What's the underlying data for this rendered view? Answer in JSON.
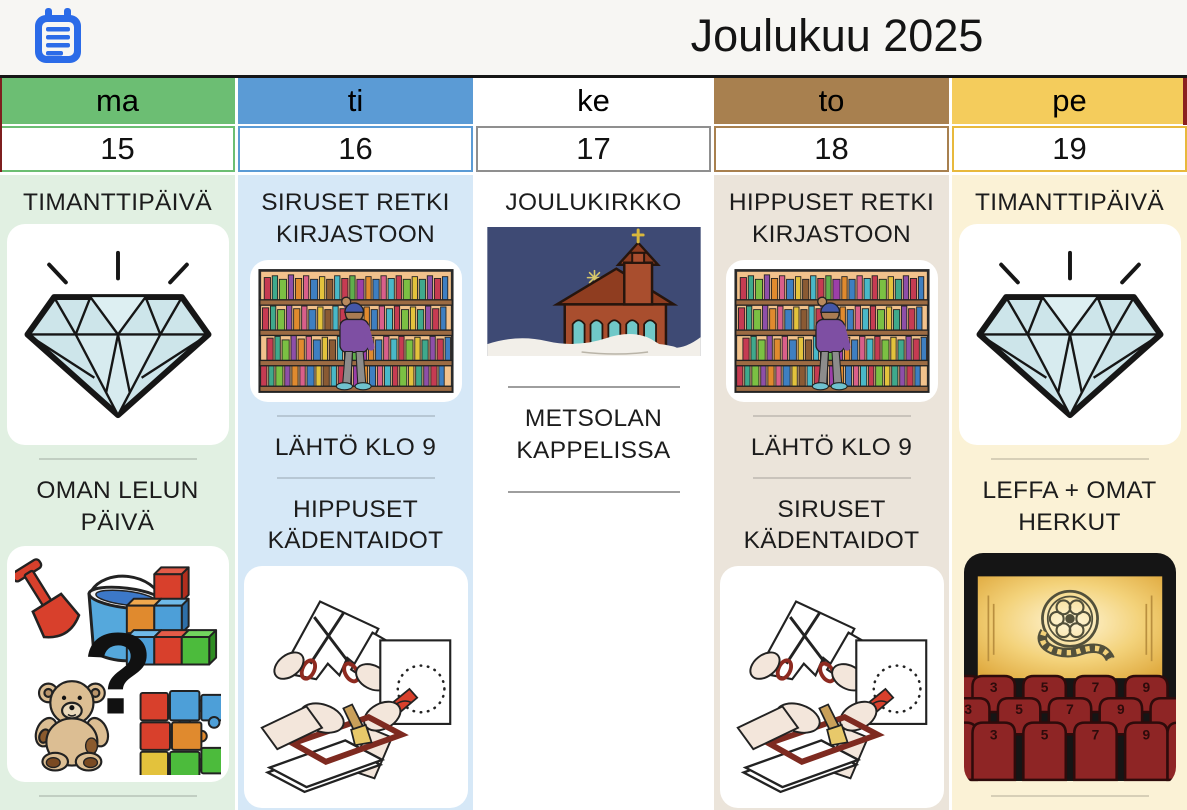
{
  "app": {
    "title": "Joulukuu 2025",
    "title_icon": "clipboard-icon"
  },
  "colors": {
    "topbar_bg": "#F7F6F3",
    "icon_blue": "#2B6BE8",
    "ma_header": "#6CBE73",
    "ma_bg": "#E1F0E2",
    "ti_header": "#5B9BD5",
    "ti_bg": "#D6E8F7",
    "ke_header": "#FFFFFF",
    "ke_bg": "#FFFFFF",
    "to_header": "#A8804F",
    "to_bg": "#EBE4DA",
    "pe_header": "#F4CC5C",
    "pe_bg": "#FBF2D6",
    "adjacent_day_sliver": "#8A2020"
  },
  "columns": [
    {
      "day": "ma",
      "date": "15",
      "activities": [
        {
          "label": "TIMANTTIPÄIVÄ",
          "image": "diamond-illustration"
        },
        {
          "label": "OMAN LELUN PÄIVÄ",
          "image": "toys-illustration"
        }
      ]
    },
    {
      "day": "ti",
      "date": "16",
      "activities": [
        {
          "label": "SIRUSET RETKI KIRJASTOON",
          "image": "library-illustration"
        },
        {
          "label": "LÄHTÖ KLO 9",
          "image": null
        },
        {
          "label": "HIPPUSET KÄDENTAIDOT",
          "image": "crafts-illustration"
        }
      ]
    },
    {
      "day": "ke",
      "date": "17",
      "activities": [
        {
          "label": "JOULUKIRKKO",
          "image": "church-illustration"
        },
        {
          "label": "METSOLAN KAPPELISSA",
          "image": null
        }
      ]
    },
    {
      "day": "to",
      "date": "18",
      "activities": [
        {
          "label": "HIPPUSET RETKI KIRJASTOON",
          "image": "library-illustration"
        },
        {
          "label": "LÄHTÖ KLO 9",
          "image": null
        },
        {
          "label": "SIRUSET KÄDENTAIDOT",
          "image": "crafts-illustration"
        }
      ]
    },
    {
      "day": "pe",
      "date": "19",
      "activities": [
        {
          "label": "TIMANTTIPÄIVÄ",
          "image": "diamond-illustration"
        },
        {
          "label": "LEFFA + OMAT HERKUT",
          "image": "cinema-illustration"
        }
      ]
    }
  ],
  "images": {
    "toys_question_mark": "?",
    "cinema_seat_numbers": [
      "3",
      "5",
      "7",
      "9"
    ]
  }
}
